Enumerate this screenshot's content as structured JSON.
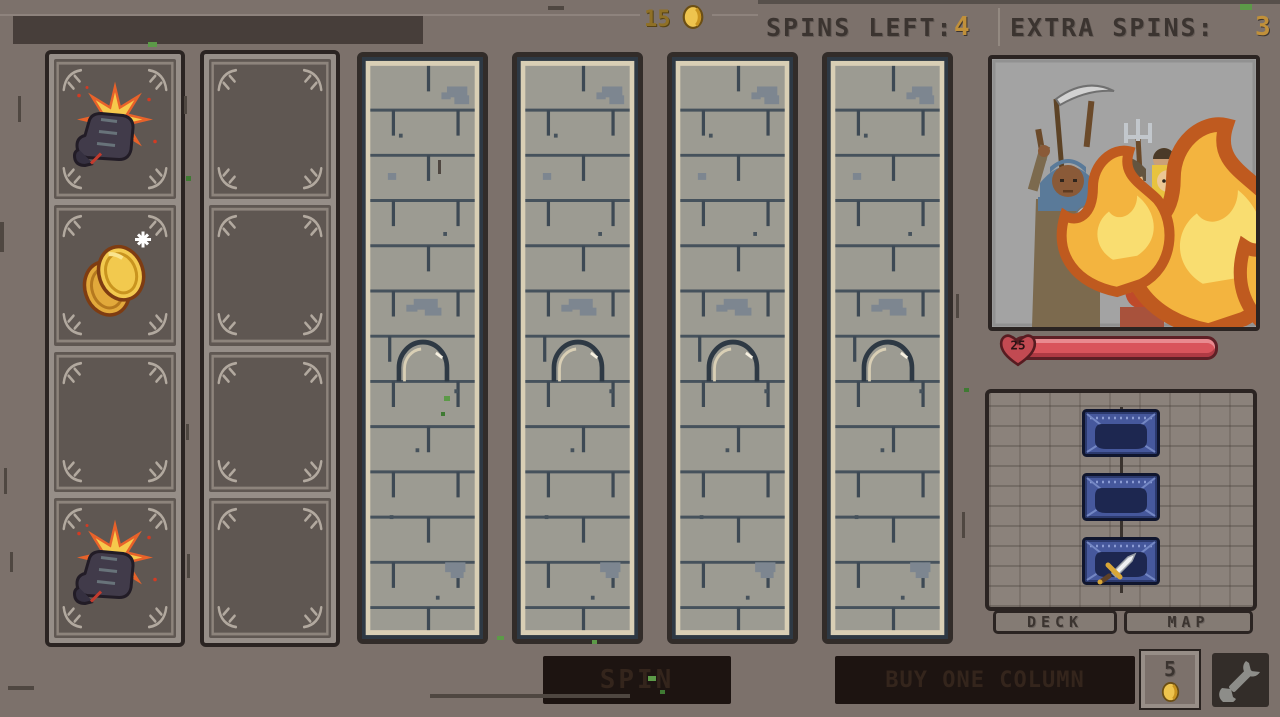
{
  "top_bar": {
    "coin_count": "15",
    "coin_icon": "gold-coin-icon",
    "spins_left_label": "SPINS LEFT:",
    "spins_left_value": "4",
    "extra_spins_label": "EXTRA SPINS:",
    "extra_spins_value": "3"
  },
  "slot_machine": {
    "columns": [
      {
        "index": 0,
        "state": "open",
        "cells": [
          "punch",
          "coins",
          "empty",
          "punch"
        ]
      },
      {
        "index": 1,
        "state": "open",
        "cells": [
          "empty",
          "empty",
          "empty",
          "empty"
        ]
      },
      {
        "index": 2,
        "state": "locked",
        "cells": []
      },
      {
        "index": 3,
        "state": "locked",
        "cells": []
      },
      {
        "index": 4,
        "state": "locked",
        "cells": []
      },
      {
        "index": 5,
        "state": "locked",
        "cells": []
      }
    ],
    "symbol_legend": {
      "punch": "fist-attack-symbol",
      "coins": "gold-coins-symbol",
      "empty": "empty-cell"
    }
  },
  "enemy": {
    "portrait": "angry-mob-with-torches",
    "hp_value": "25",
    "hp_bar_fill_percent": 100,
    "hp_bar_color": "#d9545c"
  },
  "deck_panel": {
    "cards": [
      "card-back",
      "card-back",
      "sword-card"
    ],
    "tabs": [
      {
        "label": "DECK"
      },
      {
        "label": "MAP"
      }
    ]
  },
  "actions": {
    "spin_label": "SPIN",
    "buy_column_label": "BUY ONE COLUMN",
    "buy_column_cost": "5",
    "settings_icon": "wrench-icon"
  },
  "colors": {
    "background": "#7c716b",
    "gold_text": "#c0903a",
    "coin_gold": "#eec44e",
    "hp_red": "#d9545c",
    "dark_frame": "#2b2422",
    "brick": "#9c9b92",
    "mortar": "#46525c",
    "card_blue": "#46589c",
    "button_dark": "#1d1411"
  }
}
